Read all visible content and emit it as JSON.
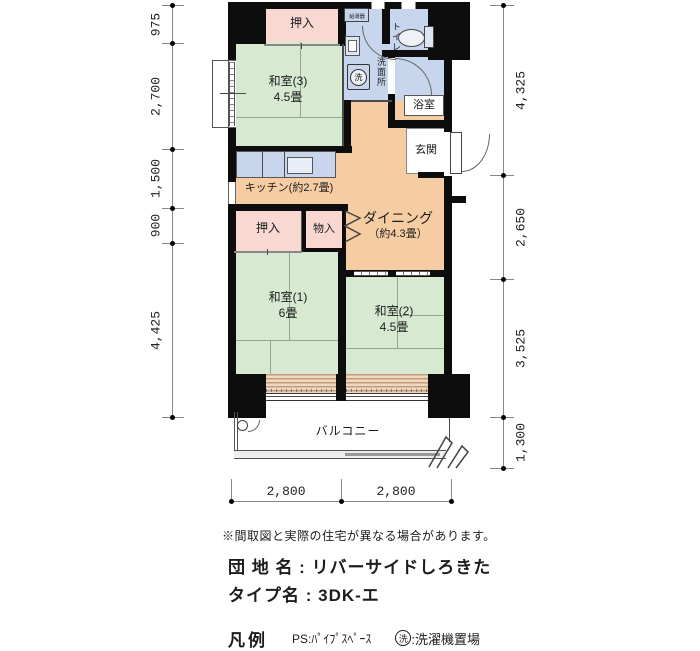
{
  "floorplan": {
    "rooms": {
      "oshiire_top": "押入",
      "washitsu3_name": "和室(3)",
      "washitsu3_size": "4.5畳",
      "water_heater": "給湯器",
      "washer_mark": "洗",
      "senmenjo": "洗面所",
      "toilet": "トイレ",
      "bath": "浴室",
      "genkan": "玄関",
      "kitchen": "キッチン(約2.7畳)",
      "dining_name": "ダイニング",
      "dining_size": "（約4.3畳）",
      "oshiire_mid": "押入",
      "monoire": "物入",
      "washitsu1_name": "和室(1)",
      "washitsu1_size": "6畳",
      "washitsu2_name": "和室(2)",
      "washitsu2_size": "4.5畳",
      "balcony": "バルコニー"
    },
    "dimensions": {
      "left": [
        "975",
        "2,700",
        "1,500",
        "900",
        "4,425"
      ],
      "right": [
        "4,325",
        "2,650",
        "3,525",
        "1,300"
      ],
      "bottom": [
        "2,800",
        "2,800"
      ]
    },
    "colors": {
      "tatami": "#d8e9d2",
      "wood_floor": "#f6cda3",
      "closet": "#f8d8d0",
      "wet_area": "#c7d6ec",
      "wall": "#0d0d0d"
    }
  },
  "info": {
    "disclaimer": "※間取図と実際の住宅が異なる場合があります。",
    "estate_label": "団 地 名 : ",
    "estate_name": "リバーサイドしろきた",
    "type_label": "タイプ名 : ",
    "type_name": "3DK-エ",
    "legend_title": "凡例",
    "legend_ps": "PS:ﾊﾟｲﾌﾟｽﾍﾟｰｽ",
    "legend_washer_mark": "洗",
    "legend_washer_text": ":洗濯機置場"
  }
}
